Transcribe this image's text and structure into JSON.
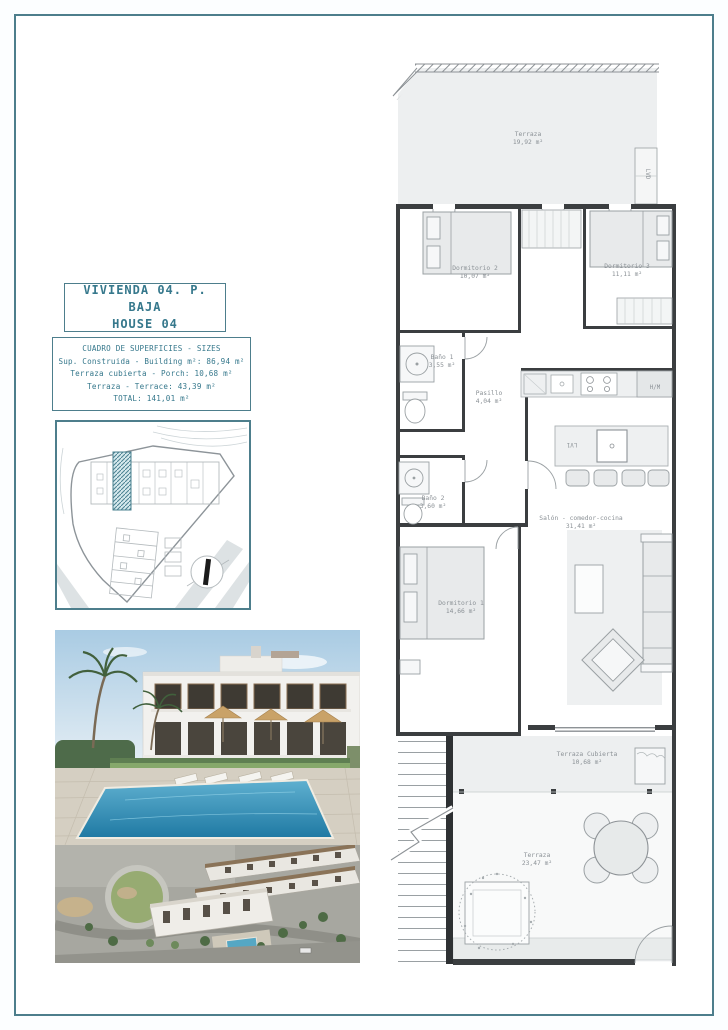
{
  "document": {
    "title_line1": "VIVIENDA 04. P. BAJA",
    "title_line2": "HOUSE 04"
  },
  "surface_table": {
    "header": "CUADRO DE SUPERFICIES  - SIZES",
    "rows": [
      "Sup. Construida  - Building m²: 86,94 m²",
      "Terraza cubierta  - Porch: 10,68 m²",
      "Terraza  - Terrace: 43,39 m²",
      "TOTAL:  141,01 m²"
    ]
  },
  "floor_plan": {
    "rooms": [
      {
        "name": "Terraza",
        "area": "19,92 m²"
      },
      {
        "name": "Dormitorio 2",
        "area": "10,07 m²"
      },
      {
        "name": "Dormitorio 3",
        "area": "11,11 m²"
      },
      {
        "name": "Baño 1",
        "area": "3,55 m²"
      },
      {
        "name": "Pasillo",
        "area": "4,04 m²"
      },
      {
        "name": "Baño 2",
        "area": "3,60 m²"
      },
      {
        "name": "Dormitorio 1",
        "area": "14,66 m²"
      },
      {
        "name": "Salón - comedor-cocina",
        "area": "31,41 m²"
      },
      {
        "name": "Terraza Cubierta",
        "area": "10,68 m²"
      },
      {
        "name": "Terraza",
        "area": "23,47 m²"
      }
    ],
    "appliances": {
      "laundry": "LVD",
      "oven_column": "H/M",
      "dishwasher": "LV1"
    }
  },
  "colors": {
    "frame_teal": "#4d7e8c",
    "title_teal": "#36788c",
    "wall_dark": "#3b3e40",
    "label_gray": "#8b9196",
    "site_highlight": "#4a8191",
    "pool_blue": "#3a92b8"
  }
}
